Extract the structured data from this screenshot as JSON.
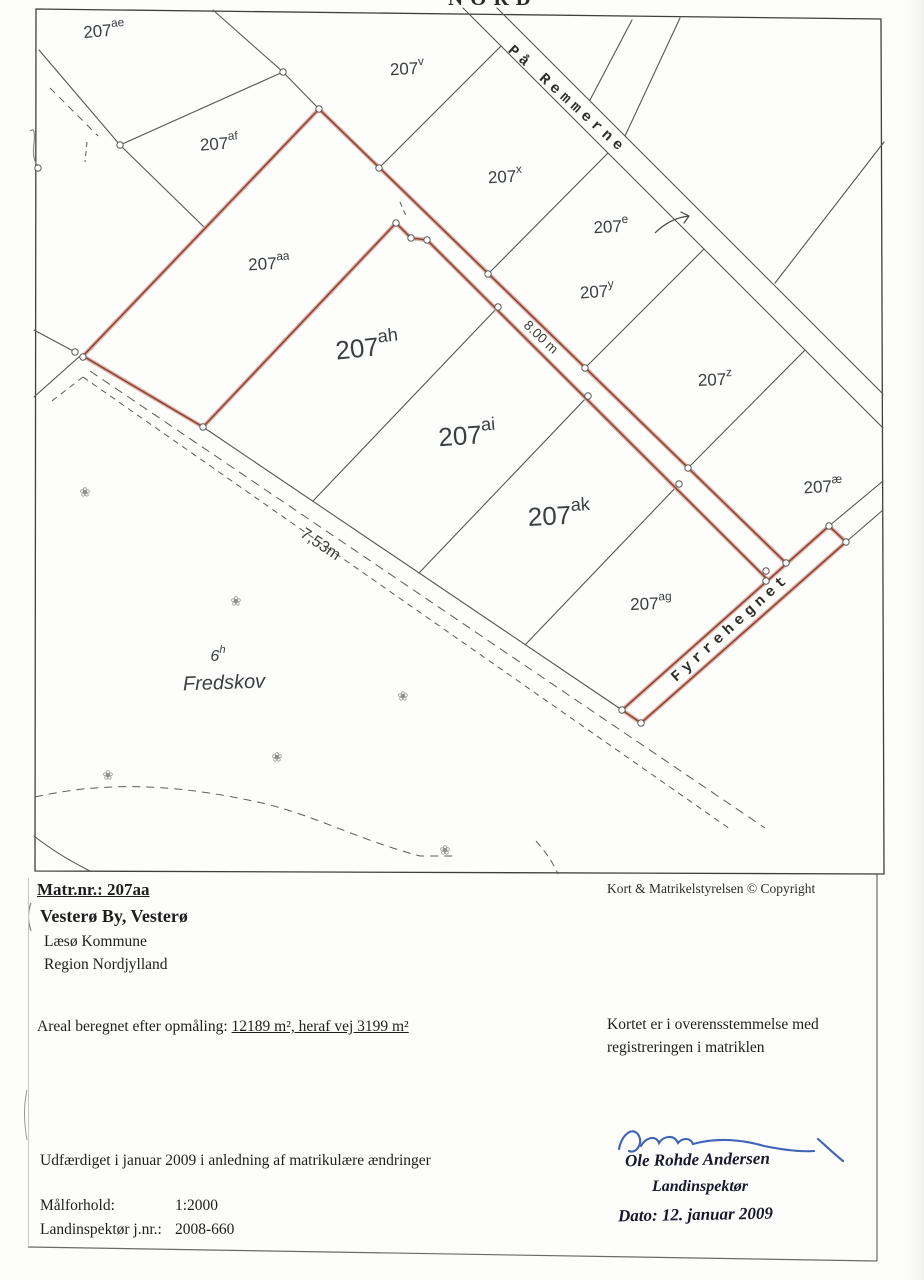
{
  "map": {
    "north_label": "NORD",
    "roads": [
      {
        "name": "På Remmerne"
      },
      {
        "name": "Fyrrehegnet"
      }
    ],
    "measurements": [
      {
        "label": "8.00 m"
      },
      {
        "label": "7,53m"
      }
    ],
    "parcels": [
      {
        "base": "207",
        "sup": "ae"
      },
      {
        "base": "207",
        "sup": "v"
      },
      {
        "base": "207",
        "sup": "af"
      },
      {
        "base": "207",
        "sup": "x"
      },
      {
        "base": "207",
        "sup": "e"
      },
      {
        "base": "207",
        "sup": "aa"
      },
      {
        "base": "207",
        "sup": "y"
      },
      {
        "base": "207",
        "sup": "ah"
      },
      {
        "base": "207",
        "sup": "z"
      },
      {
        "base": "207",
        "sup": "ai"
      },
      {
        "base": "207",
        "sup": "æ"
      },
      {
        "base": "207",
        "sup": "ak"
      },
      {
        "base": "207",
        "sup": "ag"
      },
      {
        "base": "6",
        "sup": "h"
      }
    ],
    "forest_label": "Fredskov"
  },
  "footer": {
    "matr_nr": "Matr.nr.: 207aa",
    "by": "Vesterø By, Vesterø",
    "kommune": "Læsø Kommune",
    "region": "Region Nordjylland",
    "copyright": "Kort & Matrikelstyrelsen  ©  Copyright",
    "areal_prefix": "Areal beregnet efter opmåling: ",
    "areal_value": "12189 m², heraf vej 3199 m²",
    "konsistens_1": "Kortet er i overensstemmelse med",
    "konsistens_2": "registreringen i matriklen",
    "udfaerdiget": "Udfærdiget i januar 2009 i anledning af matrikulære ændringer",
    "maalforhold_label": "Målforhold:",
    "maalforhold_value": "1:2000",
    "jnr_label": "Landinspektør j.nr.:",
    "jnr_value": "2008-660",
    "signature_name": "Ole Rohde Andersen",
    "signature_title": "Landinspektør",
    "signature_date": "Dato: 12. januar 2009"
  },
  "colors": {
    "boundary_red": "#8f4536",
    "boundary_red_halo": "#d9aca0",
    "line_gray": "#4d4d4d",
    "signature_blue": "#3f63b5"
  }
}
